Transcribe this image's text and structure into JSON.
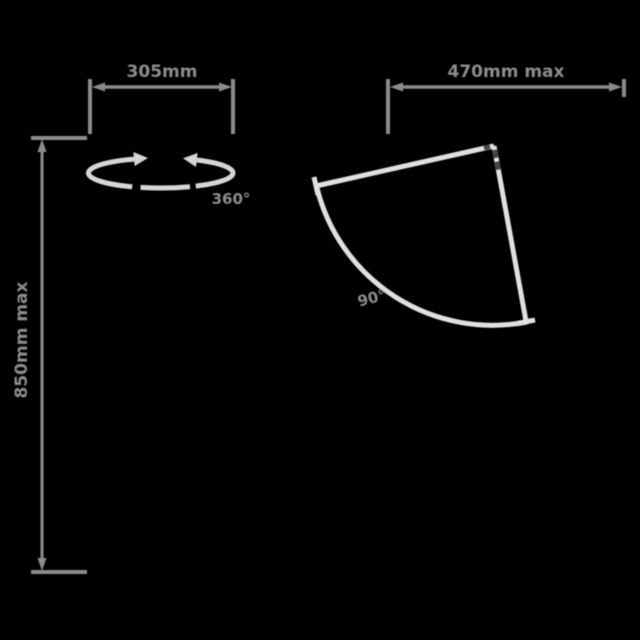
{
  "diagram_title": "Product dimension diagram",
  "labels": {
    "width": "305mm",
    "height": "850mm max",
    "swivel": "360°",
    "reach": "470mm max",
    "fold": "90°"
  },
  "colors": {
    "background": "#000000",
    "dimension": "#8c8c8c",
    "label": "#8c8c8c",
    "product": "#e0e0e0",
    "rotation": "#d6d6d6",
    "hinge": "#454545"
  }
}
